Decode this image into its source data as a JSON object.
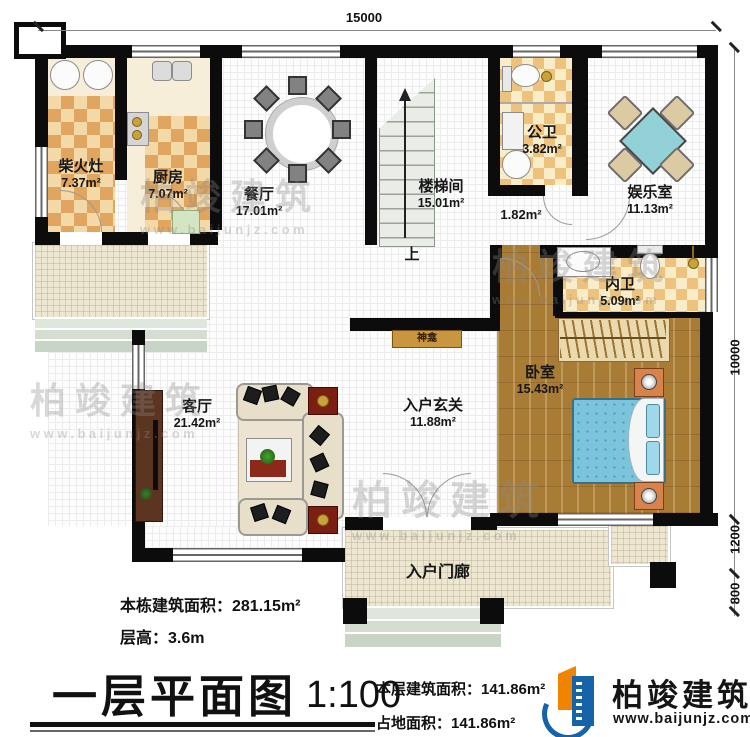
{
  "dims": {
    "top": "15000",
    "right_main": "10000",
    "right_mid": "1200",
    "right_low": "800"
  },
  "rooms": {
    "chaihuozao": {
      "name": "柴火灶",
      "area": "7.37m²"
    },
    "chufang": {
      "name": "厨房",
      "area": "7.07m²"
    },
    "canting": {
      "name": "餐厅",
      "area": "17.01m²"
    },
    "loutijian": {
      "name": "楼梯间",
      "area": "15.01m²"
    },
    "gongwei": {
      "name": "公卫",
      "area": "3.82m²"
    },
    "yuleshi": {
      "name": "娱乐室",
      "area": "11.13m²"
    },
    "corridor": {
      "area": "1.82m²"
    },
    "neiwei": {
      "name": "内卫",
      "area": "5.09m²"
    },
    "woshi": {
      "name": "卧室",
      "area": "15.43m²"
    },
    "keting": {
      "name": "客厅",
      "area": "21.42m²"
    },
    "xuanguan": {
      "name": "入户玄关",
      "area": "11.88m²"
    },
    "menlang": {
      "name": "入户门廊"
    },
    "shenkan": {
      "name": "神龛"
    },
    "stairs": {
      "up_label": "上"
    }
  },
  "notes": {
    "building_area": "本栋建筑面积：281.15m²",
    "floor_height": "层高：3.6m"
  },
  "title_block": {
    "title": "一层平面图",
    "scale": "1:100",
    "floor_area": "本层建筑面积：141.86m²",
    "footprint_area": "占地面积：141.86m²"
  },
  "brand": {
    "name": "柏竣建筑",
    "url": "www.baijunjz.com"
  },
  "watermark": {
    "name": "柏竣建筑",
    "url": "www.baijunjz.com"
  },
  "colors": {
    "wall": "#0c0c0c",
    "checker_dark": "#e0a55e",
    "wood": "#a97c35",
    "bed_blue": "#7cc3dc",
    "table_teal": "#92d2d6",
    "porch": "#ede7d2",
    "logo_blue": "#1663a7",
    "logo_orange": "#f08300"
  }
}
